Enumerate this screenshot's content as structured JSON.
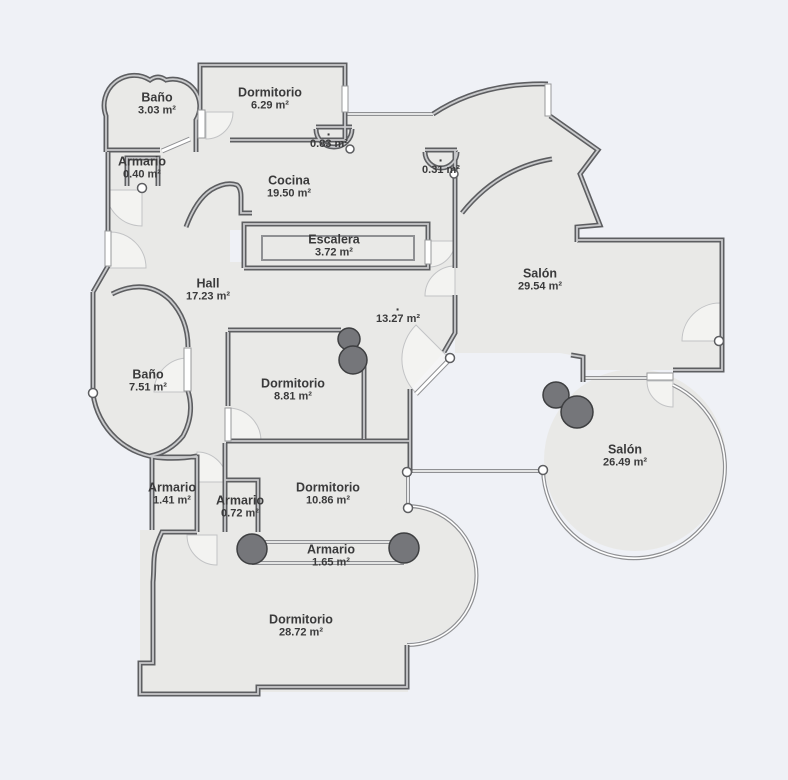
{
  "plan": {
    "background_color": "#eff1f6",
    "floor_color": "#e9e9e7",
    "wall_color": "#5d5e61",
    "wall_fill_color": "#c9cacc",
    "thin_wall_color": "#8f9093",
    "column_color": "#75767a",
    "column_border_color": "#3e3f41",
    "door_arc_color": "#f7f7f5",
    "hinge_color": "#ffffff",
    "label_color": "#3a3a3b"
  },
  "rooms": [
    {
      "dot": "",
      "name": "Baño",
      "area": "3.03 m²"
    },
    {
      "dot": "",
      "name": "Dormitorio",
      "area": "6.29 m²"
    },
    {
      "dot": "",
      "name": "Armario",
      "area": "0.40 m²"
    },
    {
      "dot": "·",
      "name": "",
      "area": "0.83 m²"
    },
    {
      "dot": "",
      "name": "Cocina",
      "area": "19.50 m²"
    },
    {
      "dot": "·",
      "name": "",
      "area": "0.31 m²"
    },
    {
      "dot": "",
      "name": "Escalera",
      "area": "3.72 m²"
    },
    {
      "dot": "",
      "name": "Salón",
      "area": "29.54 m²"
    },
    {
      "dot": "",
      "name": "Hall",
      "area": "17.23 m²"
    },
    {
      "dot": "·",
      "name": "",
      "area": "13.27 m²"
    },
    {
      "dot": "",
      "name": "Baño",
      "area": "7.51 m²"
    },
    {
      "dot": "",
      "name": "Dormitorio",
      "area": "8.81 m²"
    },
    {
      "dot": "",
      "name": "Salón",
      "area": "26.49 m²"
    },
    {
      "dot": "",
      "name": "Armario",
      "area": "1.41 m²"
    },
    {
      "dot": "",
      "name": "Armario",
      "area": "0.72 m²"
    },
    {
      "dot": "",
      "name": "Dormitorio",
      "area": "10.86 m²"
    },
    {
      "dot": "",
      "name": "Armario",
      "area": "1.65 m²"
    },
    {
      "dot": "",
      "name": "Dormitorio",
      "area": "28.72 m²"
    }
  ]
}
